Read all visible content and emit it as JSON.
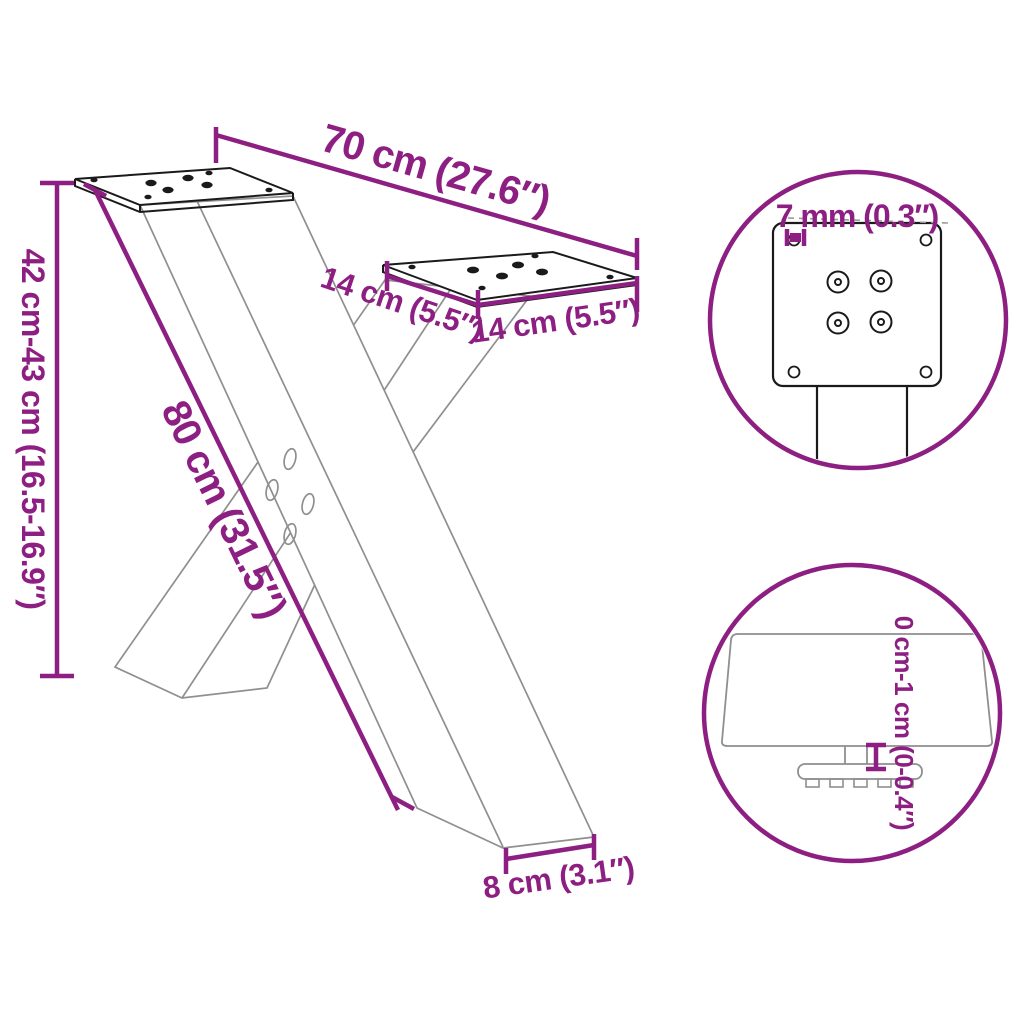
{
  "diagram": {
    "title": "X-shaped table leg dimension diagram",
    "colors": {
      "accent": "#8E1F82",
      "line_gray": "#8F8F8F",
      "line_dark": "#1A1A1A",
      "leader_gray": "#9A9A9A",
      "background": "#FFFFFF"
    },
    "main": {
      "dim_top_width": "70 cm (27.6″)",
      "dim_height_range": "42 cm-43 cm (16.5-16.9″)",
      "dim_strut_length": "80 cm (31.5″)",
      "dim_plate_depth": "14 cm (5.5″)",
      "dim_plate_width": "14 cm (5.5″)",
      "dim_foot_width": "8 cm (3.1″)"
    },
    "detail_top_circle": {
      "dim_hole": "7 mm (0.3″)"
    },
    "detail_bottom_circle": {
      "dim_adjustable_height": "0 cm-1 cm (0-0.4″)"
    }
  }
}
